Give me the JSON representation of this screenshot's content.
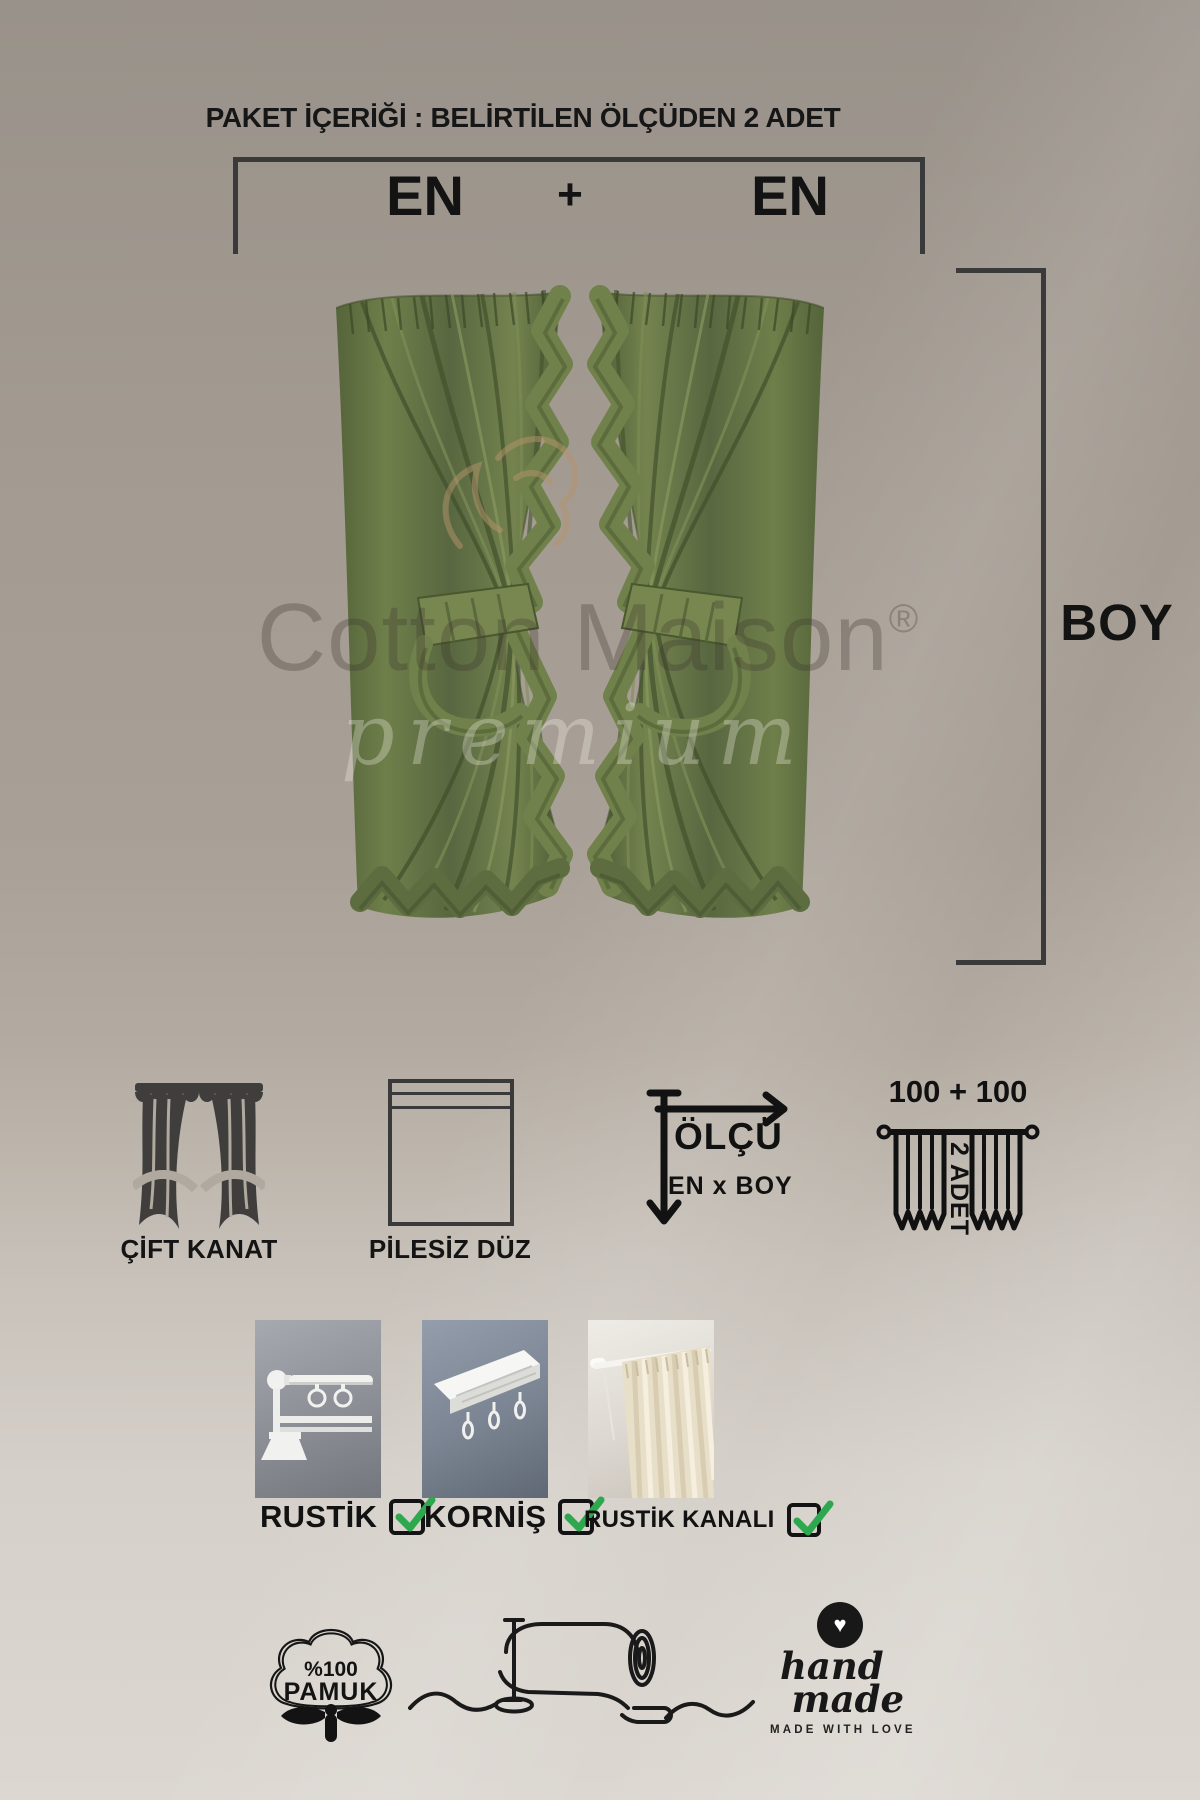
{
  "header": {
    "title": "PAKET İÇERİĞİ : BELİRTİLEN ÖLÇÜDEN 2 ADET"
  },
  "measurements": {
    "width_left": "EN",
    "plus": "+",
    "width_right": "EN",
    "height": "BOY"
  },
  "watermark": {
    "brand": "Cotton Maison",
    "registered": "®",
    "premium": "premium"
  },
  "features": {
    "double_panel": {
      "label": "ÇİFT KANAT"
    },
    "flat": {
      "label": "PİLESİZ DÜZ"
    },
    "measure": {
      "label": "ÖLÇÜ",
      "sublabel": "EN x BOY"
    },
    "quantity": {
      "size_text": "100 + 100",
      "qty_text": "2 ADET"
    }
  },
  "mounting": {
    "options": [
      {
        "label": "RUSTİK",
        "checked": true
      },
      {
        "label": "KORNİŞ",
        "checked": true
      },
      {
        "label": "RUSTİK KANALI",
        "checked": true
      }
    ]
  },
  "badges": {
    "cotton": {
      "line1": "%100",
      "line2": "PAMUK"
    },
    "handmade": {
      "word1": "hand",
      "word2": "made",
      "tagline": "MADE WITH LOVE"
    }
  },
  "colors": {
    "text_black": "#141414",
    "line_dark": "#3a3a3a",
    "check_green": "#2da84f",
    "curtain_green": "#5e6e41",
    "background_top": "#99928a",
    "background_bottom": "#dcd7d1",
    "ornament_tan": "#b6946d"
  }
}
